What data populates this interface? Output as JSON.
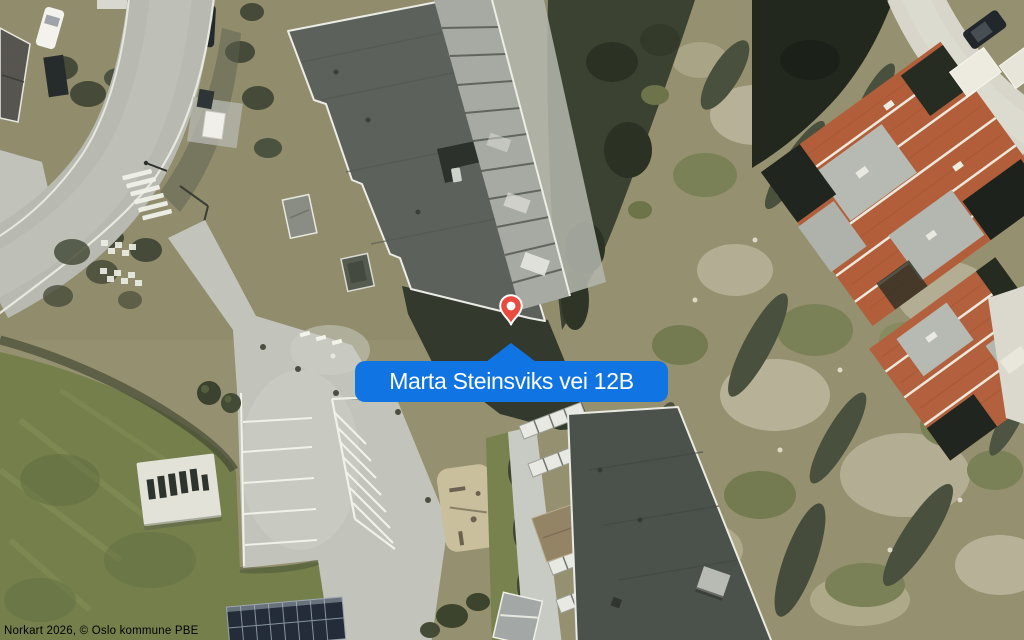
{
  "map_view": {
    "callout": {
      "address_label": "Marta Steinsviks vei 12B"
    },
    "marker": {
      "icon": "location-pin-icon"
    },
    "attribution": {
      "text": "Norkart 2026, © Oslo kommune PBE"
    },
    "colors": {
      "callout_background": "#1174e3",
      "callout_text": "#ffffff",
      "pin_fill": "#ea4b3e",
      "pin_outline": "#ffffff",
      "pin_dot": "#ffffff"
    }
  }
}
